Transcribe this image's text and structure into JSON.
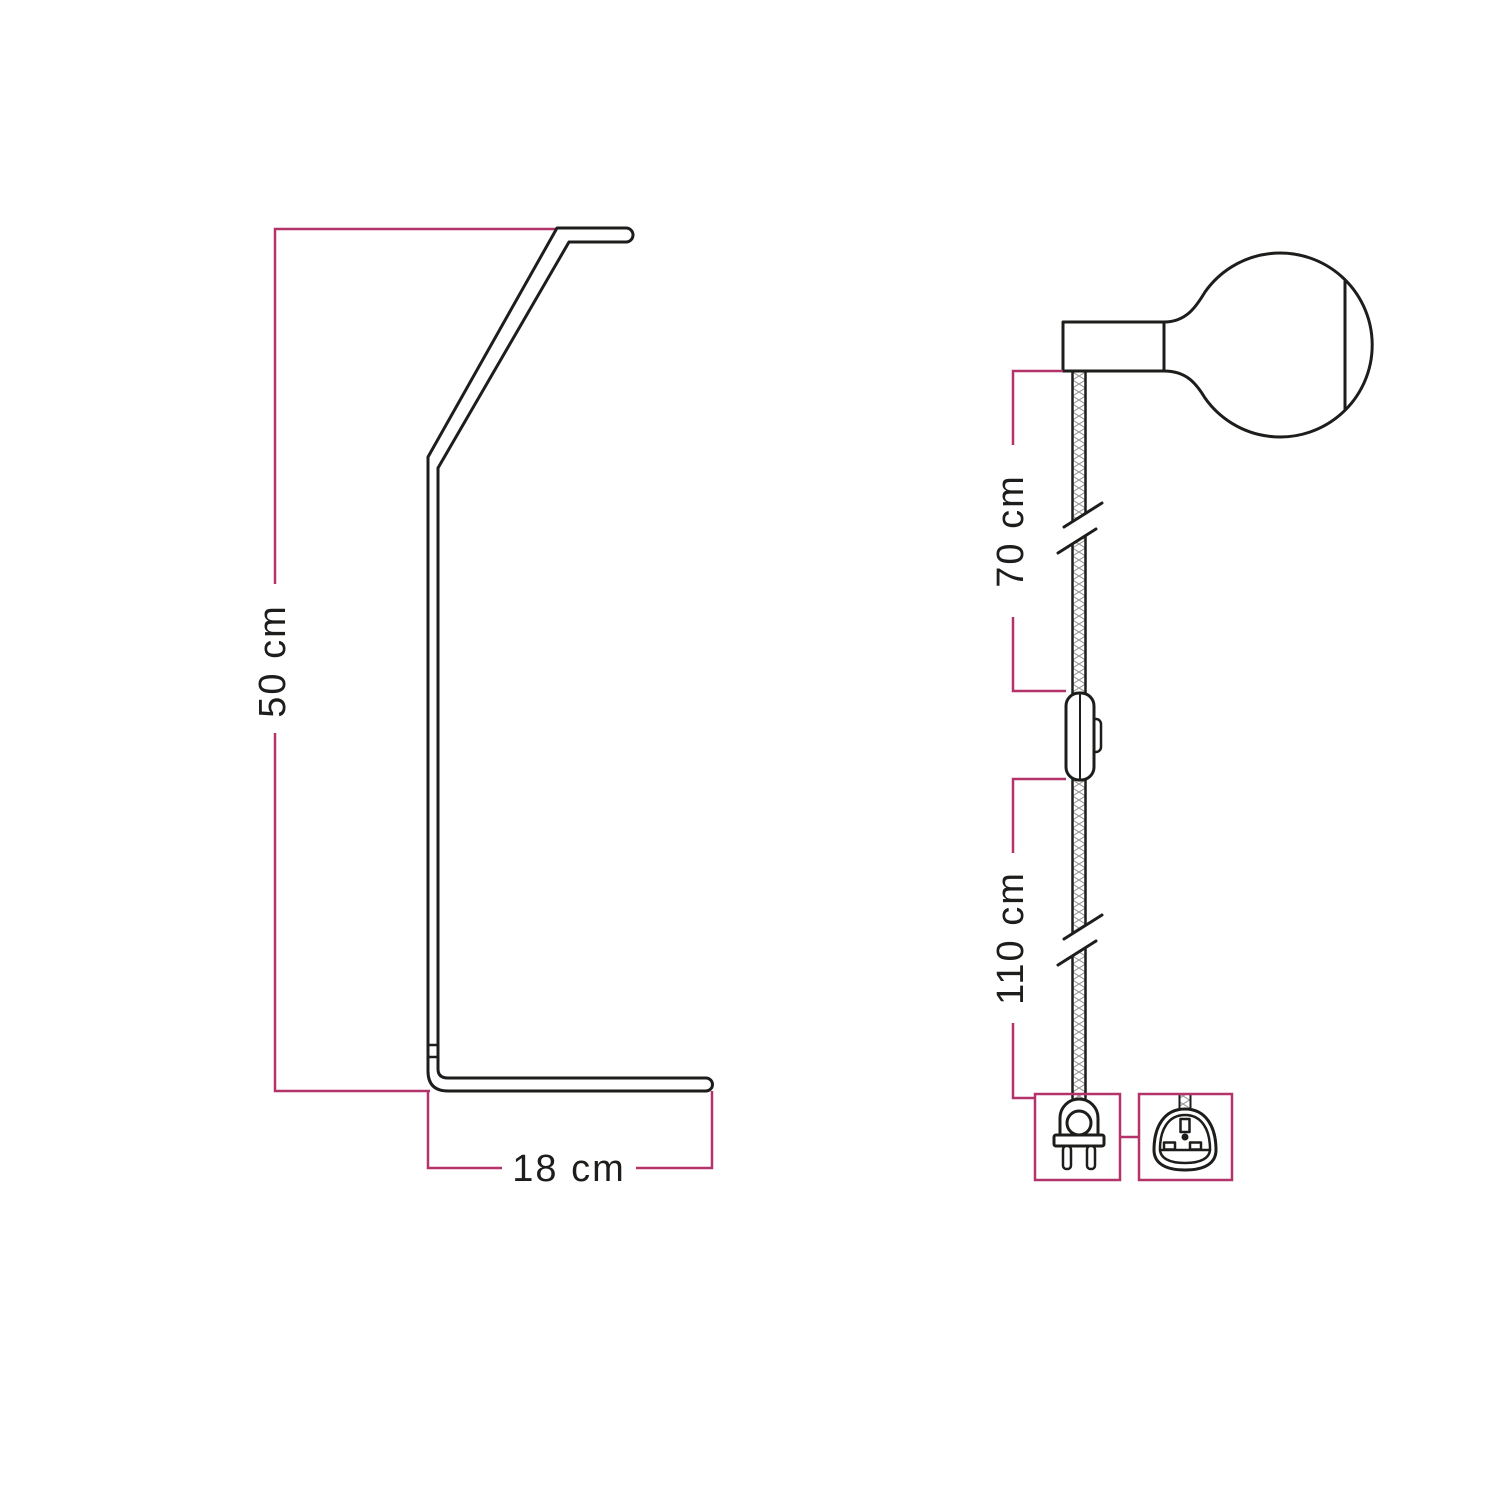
{
  "diagram": {
    "kind": "product-dimension-drawing",
    "subject": "floor/table lamp stand with textile cable, lamp holder, globe bulb, inline switch and plug"
  },
  "colors": {
    "background": "#ffffff",
    "line": "#1d1d1b",
    "accent": "#b5336b",
    "hatch": "#9a9a9a"
  },
  "left_figure": {
    "name": "stand-side-profile",
    "height_dimension": "50 cm",
    "depth_dimension": "18 cm"
  },
  "right_figure": {
    "name": "cable-assembly",
    "upper_cable_dimension": "70 cm",
    "lower_cable_dimension": "110 cm"
  },
  "icons": [
    "bulb-globe-icon",
    "lamp-holder-icon",
    "textile-cable",
    "cable-break-icon",
    "inline-switch-icon",
    "euro-plug-icon",
    "uk-plug-icon"
  ]
}
